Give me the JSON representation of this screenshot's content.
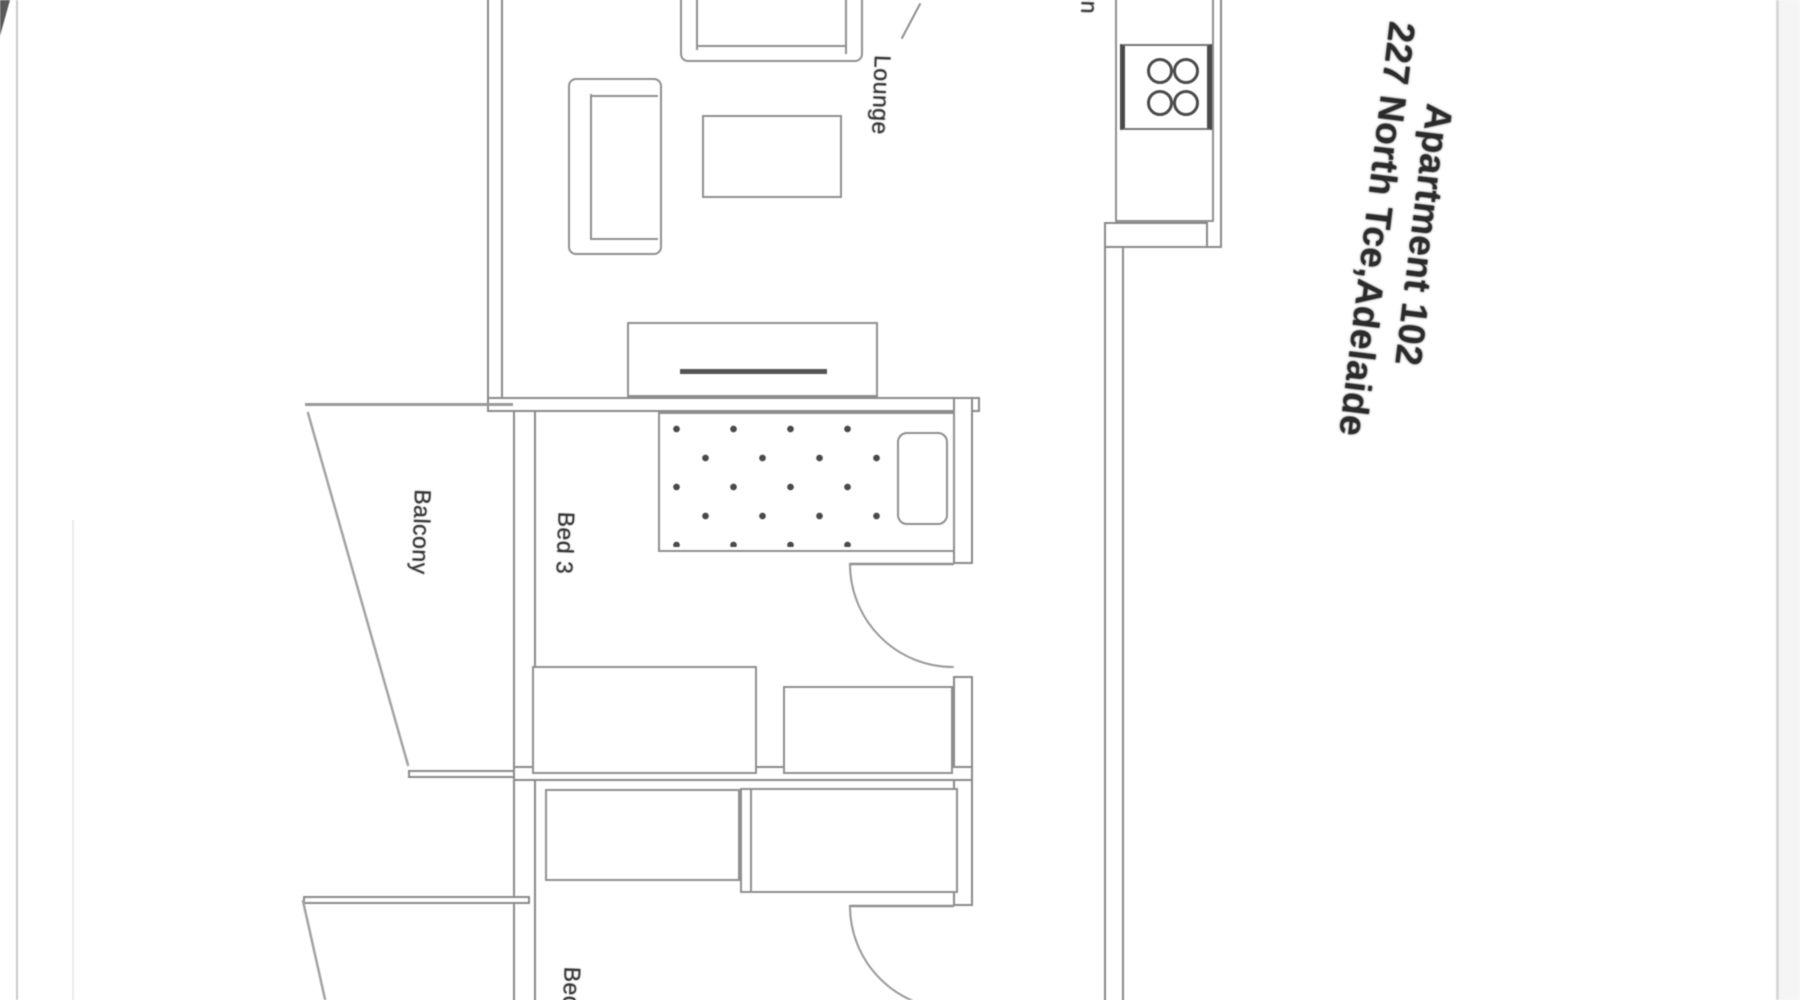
{
  "window": {
    "width": 1800,
    "height": 1000
  },
  "title": {
    "line1": "Apartment 102",
    "line2": "227 North Tce,Adelaide"
  },
  "rooms": {
    "lounge": "Lounge",
    "balcony": "Balcony",
    "bed3": "Bed 3",
    "bed2": "Bed 2",
    "kitchen": "Kitchen"
  },
  "icons": {
    "stove": "stove-burners-icon",
    "door_swing": "door-swing-icon"
  },
  "colors": {
    "wall_line": "#8a8a8a",
    "thin_line": "#a3a3a3",
    "dark_accent": "#4a4a4a",
    "label_text": "#333333",
    "title_text": "#2b2b2b",
    "photo_edge": "#d8d8d8",
    "background": "#ffffff"
  }
}
